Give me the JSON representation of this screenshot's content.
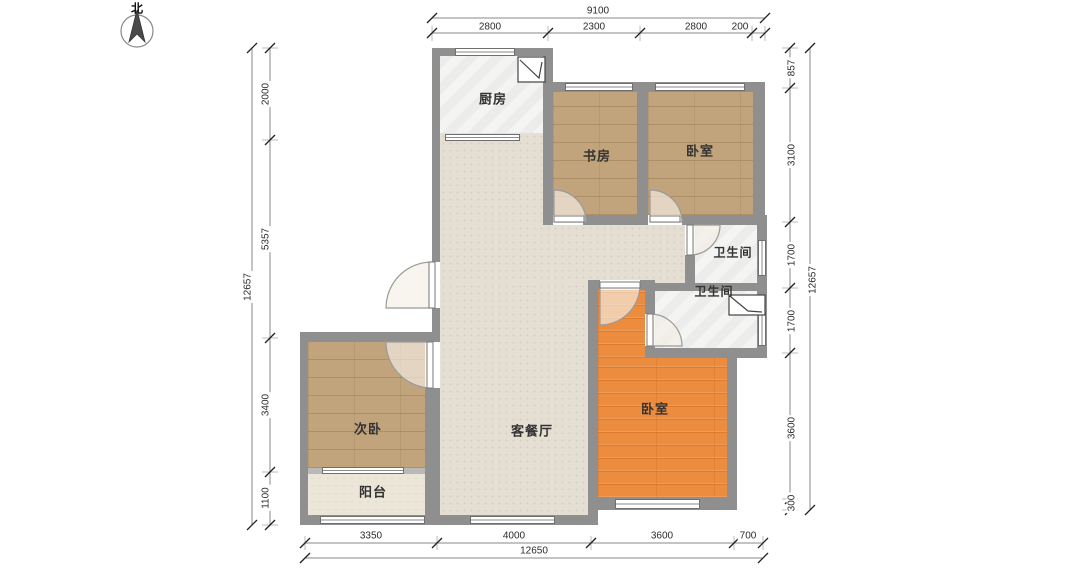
{
  "north_label": "北",
  "rooms": {
    "kitchen": "厨房",
    "study": "书房",
    "bedroom_top": "卧室",
    "bath_upper": "卫生间",
    "bath_lower": "卫生间",
    "bedroom_main": "卧室",
    "second_bedroom": "次卧",
    "living_dining": "客餐厅",
    "balcony": "阳台"
  },
  "dimensions": {
    "top": {
      "total": "9100",
      "segments": [
        "2800",
        "2300",
        "2800",
        "200"
      ]
    },
    "left": {
      "total": "12657",
      "segments": [
        "2000",
        "5357",
        "3400",
        "1100"
      ]
    },
    "right": {
      "total": "12657",
      "segments": [
        "857",
        "3100",
        "1700",
        "1700",
        "3600",
        "300"
      ]
    },
    "bottom": {
      "total": "12650",
      "segments": [
        "3350",
        "4000",
        "3600",
        "700"
      ]
    }
  },
  "colors": {
    "wall": "#8f8f8f",
    "wood_floor": "#c2a47c",
    "orange_floor": "#ec8c3f",
    "living_floor": "#e4ded3",
    "tile_floor": "#f4f4f2",
    "balcony_floor": "#ece6d9"
  }
}
